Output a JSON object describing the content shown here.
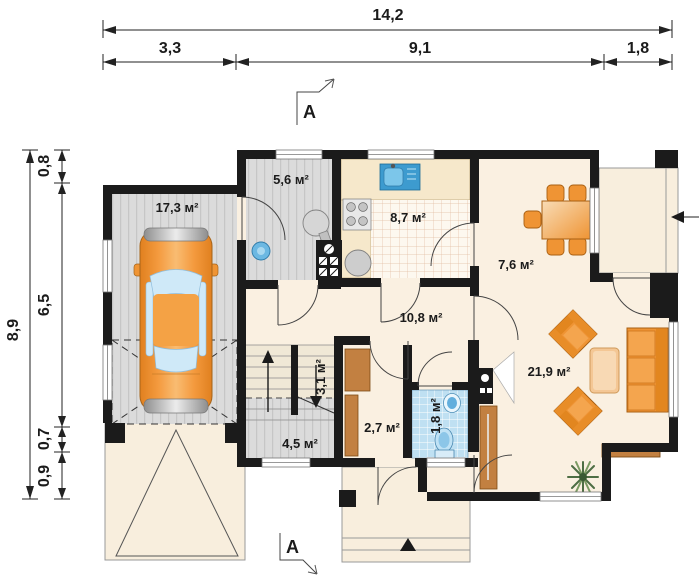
{
  "dimensions": {
    "top": {
      "total": "14,2",
      "segments": [
        "3,3",
        "9,1",
        "1,8"
      ]
    },
    "left": {
      "total": "8,9",
      "segments": [
        "0,8",
        "6,5",
        "0,7",
        "0,9"
      ]
    }
  },
  "sections": {
    "top": "A",
    "bottom": "A"
  },
  "rooms": {
    "garage": "17,3 м²",
    "vestibule": "5,6 м²",
    "kitchen": "8,7 м²",
    "dining": "7,6 м²",
    "hall": "10,8 м²",
    "stairs": "3,1 м²",
    "storage": "4,5 м²",
    "pantry": "2,7 м²",
    "bathroom": "1,8 м²",
    "living": "21,9 м²"
  },
  "colors": {
    "wall": "#1b1b1b",
    "floor_cream": "#faf0e1",
    "floor_gray": "#dbdbdb",
    "tile_blue": "#bfe0f2",
    "furniture_orange": "#ef9434",
    "wood_brown": "#c28041",
    "car_orange": "#f49a3e",
    "window_glass": "#cfe9f8"
  }
}
